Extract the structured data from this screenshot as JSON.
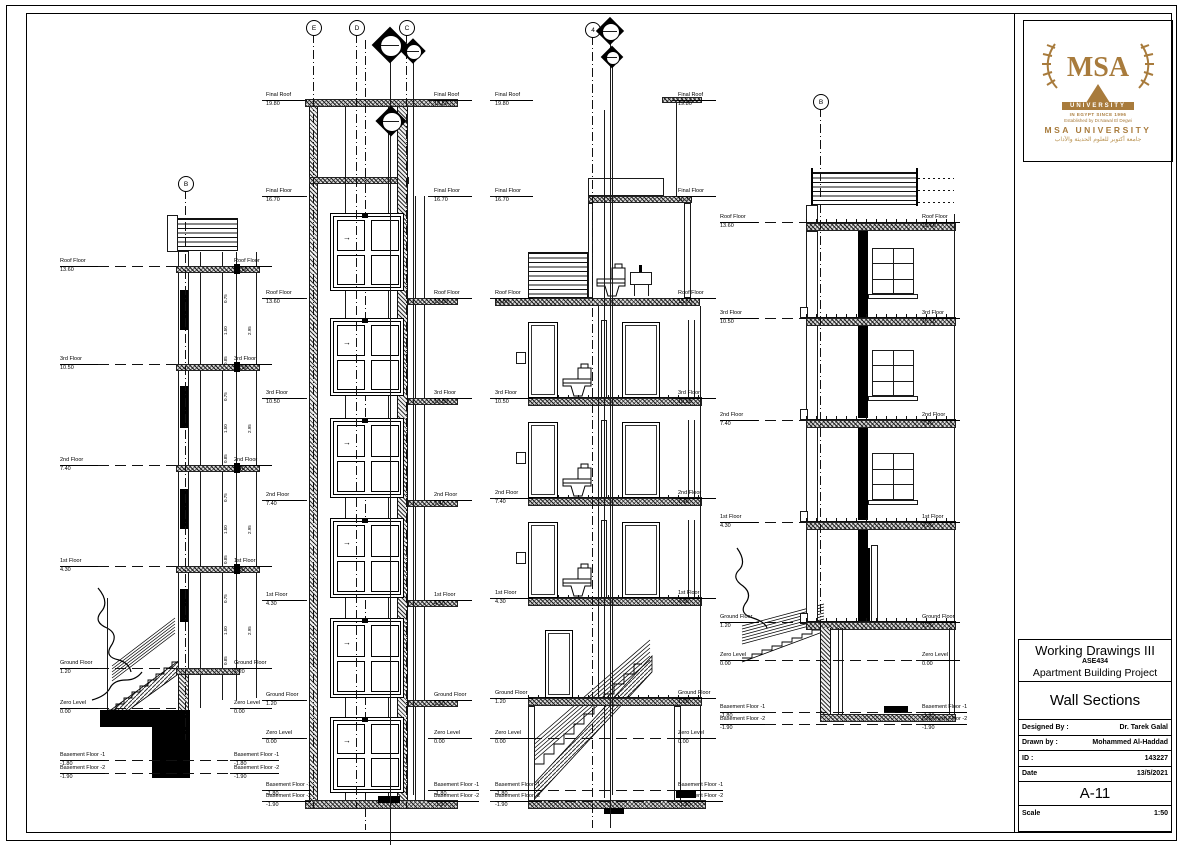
{
  "title_block": {
    "course": "Working Drawings III",
    "course_code": "ASE434",
    "project": "Apartment Building Project",
    "sheet_title": "Wall Sections",
    "designed_by_label": "Designed By :",
    "designed_by": "Dr. Tarek Galal",
    "drawn_by_label": "Drawn by :",
    "drawn_by": "Mohammed Al-Haddad",
    "id_label": "ID :",
    "id": "143227",
    "date_label": "Date",
    "date": "13/5/2021",
    "sheet_no": "A-11",
    "scale_label": "Scale",
    "scale": "1:50"
  },
  "logo": {
    "monogram": "MSA",
    "banner": "UNIVERSITY",
    "since": "IN EGYPT SINCE 1996",
    "established": "Established by Dr.Nawal El Degwi",
    "name": "MSA UNIVERSITY",
    "arabic": "جامعة أكتوبر للعلوم الحديثة والآداب",
    "gold": "#a87b3c"
  },
  "drawing": {
    "door_arrow": "→",
    "dims": [
      "0.75",
      "1.50",
      "0.85",
      "2.95"
    ],
    "grid_bubbles": [
      {
        "label": "B",
        "cx": 185,
        "cy": 183,
        "to": 740
      },
      {
        "label": "E",
        "cx": 313,
        "cy": 27,
        "to": 808
      },
      {
        "label": "D",
        "cx": 356,
        "cy": 27,
        "to": 808
      },
      {
        "label": "C",
        "cx": 406,
        "cy": 27,
        "to": 808
      },
      {
        "label": "4",
        "cx": 592,
        "cy": 29,
        "to": 828
      },
      {
        "label": "B",
        "cx": 820,
        "cy": 101,
        "to": 705
      }
    ],
    "section_markers": [
      {
        "cx": 390,
        "cy": 45,
        "s": 26,
        "to": 845
      },
      {
        "cx": 413,
        "cy": 51,
        "s": 18,
        "to": 795
      },
      {
        "cx": 391,
        "cy": 121,
        "s": 22,
        "to": 0
      },
      {
        "cx": 610,
        "cy": 31,
        "s": 20,
        "to": 828
      },
      {
        "cx": 612,
        "cy": 57,
        "s": 16,
        "to": 795
      }
    ],
    "sections": [
      {
        "id": "wall-section-a",
        "left": {
          "tx": 60,
          "dash": [
            98,
            176
          ]
        },
        "right": {
          "tx": 234,
          "dash": [
            230,
            266
          ]
        },
        "levels": [
          {
            "name": "Roof Floor",
            "value": "13.60",
            "y": 266
          },
          {
            "name": "3rd Floor",
            "value": "10.50",
            "y": 364
          },
          {
            "name": "2nd Floor",
            "value": "7.40",
            "y": 465
          },
          {
            "name": "1st Floor",
            "value": "4.30",
            "y": 566
          },
          {
            "name": "Ground Floor",
            "value": "1.20",
            "y": 668
          },
          {
            "name": "Zero Level",
            "value": "0.00",
            "y": 708
          },
          {
            "name": "Basement Floor -1",
            "value": "-1.80",
            "y": 760,
            "dash2": [
              98,
              230
            ]
          },
          {
            "name": "Basement Floor -2",
            "value": "-1.90",
            "y": 773,
            "dash2": [
              98,
              230
            ]
          }
        ]
      },
      {
        "id": "wall-section-b",
        "left": {
          "tx": 266,
          "dash": [
            262,
            308
          ]
        },
        "right": {
          "tx": 434,
          "dash": [
            428,
            468
          ]
        },
        "levels": [
          {
            "name": "Final Roof",
            "value": "19.80",
            "y": 100
          },
          {
            "name": "Final Floor",
            "value": "16.70",
            "y": 196
          },
          {
            "name": "Roof Floor",
            "value": "13.60",
            "y": 298
          },
          {
            "name": "3rd Floor",
            "value": "10.50",
            "y": 398
          },
          {
            "name": "2nd Floor",
            "value": "7.40",
            "y": 500
          },
          {
            "name": "1st Floor",
            "value": "4.30",
            "y": 600
          },
          {
            "name": "Ground Floor",
            "value": "1.20",
            "y": 700
          },
          {
            "name": "Zero Level",
            "value": "0.00",
            "y": 738
          },
          {
            "name": "Basement Floor -1",
            "value": "-1.80",
            "y": 790
          },
          {
            "name": "Basement Floor -2",
            "value": "-1.90",
            "y": 801
          }
        ]
      },
      {
        "id": "wall-section-c",
        "left": {
          "tx": 495,
          "dash": [
            490,
            528
          ]
        },
        "right": {
          "tx": 678,
          "dash": [
            672,
            712
          ]
        },
        "levels": [
          {
            "name": "Final Roof",
            "value": "19.80",
            "y": 100
          },
          {
            "name": "Final Floor",
            "value": "16.70",
            "y": 196
          },
          {
            "name": "Roof Floor",
            "value": "13.60",
            "y": 298
          },
          {
            "name": "3rd Floor",
            "value": "10.50",
            "y": 398
          },
          {
            "name": "2nd Floor",
            "value": "7.40",
            "y": 498
          },
          {
            "name": "1st Floor",
            "value": "4.30",
            "y": 598
          },
          {
            "name": "Ground Floor",
            "value": "1.20",
            "y": 698
          },
          {
            "name": "Zero Level",
            "value": "0.00",
            "y": 738,
            "dash2": [
              497,
              700
            ]
          },
          {
            "name": "Basement Floor -1",
            "value": "-1.80",
            "y": 790,
            "dash2": [
              497,
              700
            ]
          },
          {
            "name": "Basement Floor -2",
            "value": "-1.90",
            "y": 801,
            "dash2": [
              497,
              700
            ]
          }
        ]
      },
      {
        "id": "wall-section-d",
        "left": {
          "tx": 720,
          "dash": [
            748,
            806
          ]
        },
        "right": {
          "tx": 922,
          "dash": [
            916,
            956
          ]
        },
        "levels": [
          {
            "name": "Roof Floor",
            "value": "13.60",
            "y": 222
          },
          {
            "name": "3rd Floor",
            "value": "10.50",
            "y": 318
          },
          {
            "name": "2nd Floor",
            "value": "7.40",
            "y": 420
          },
          {
            "name": "1st Floor",
            "value": "4.30",
            "y": 522
          },
          {
            "name": "Ground Floor",
            "value": "1.20",
            "y": 622
          },
          {
            "name": "Zero Level",
            "value": "0.00",
            "y": 660,
            "dash2": [
              748,
              950
            ]
          },
          {
            "name": "Basement Floor -1",
            "value": "-1.80",
            "y": 712,
            "dash2": [
              748,
              956
            ]
          },
          {
            "name": "Basement Floor -2",
            "value": "-1.90",
            "y": 724,
            "dash2": [
              748,
              956
            ]
          }
        ]
      }
    ]
  }
}
